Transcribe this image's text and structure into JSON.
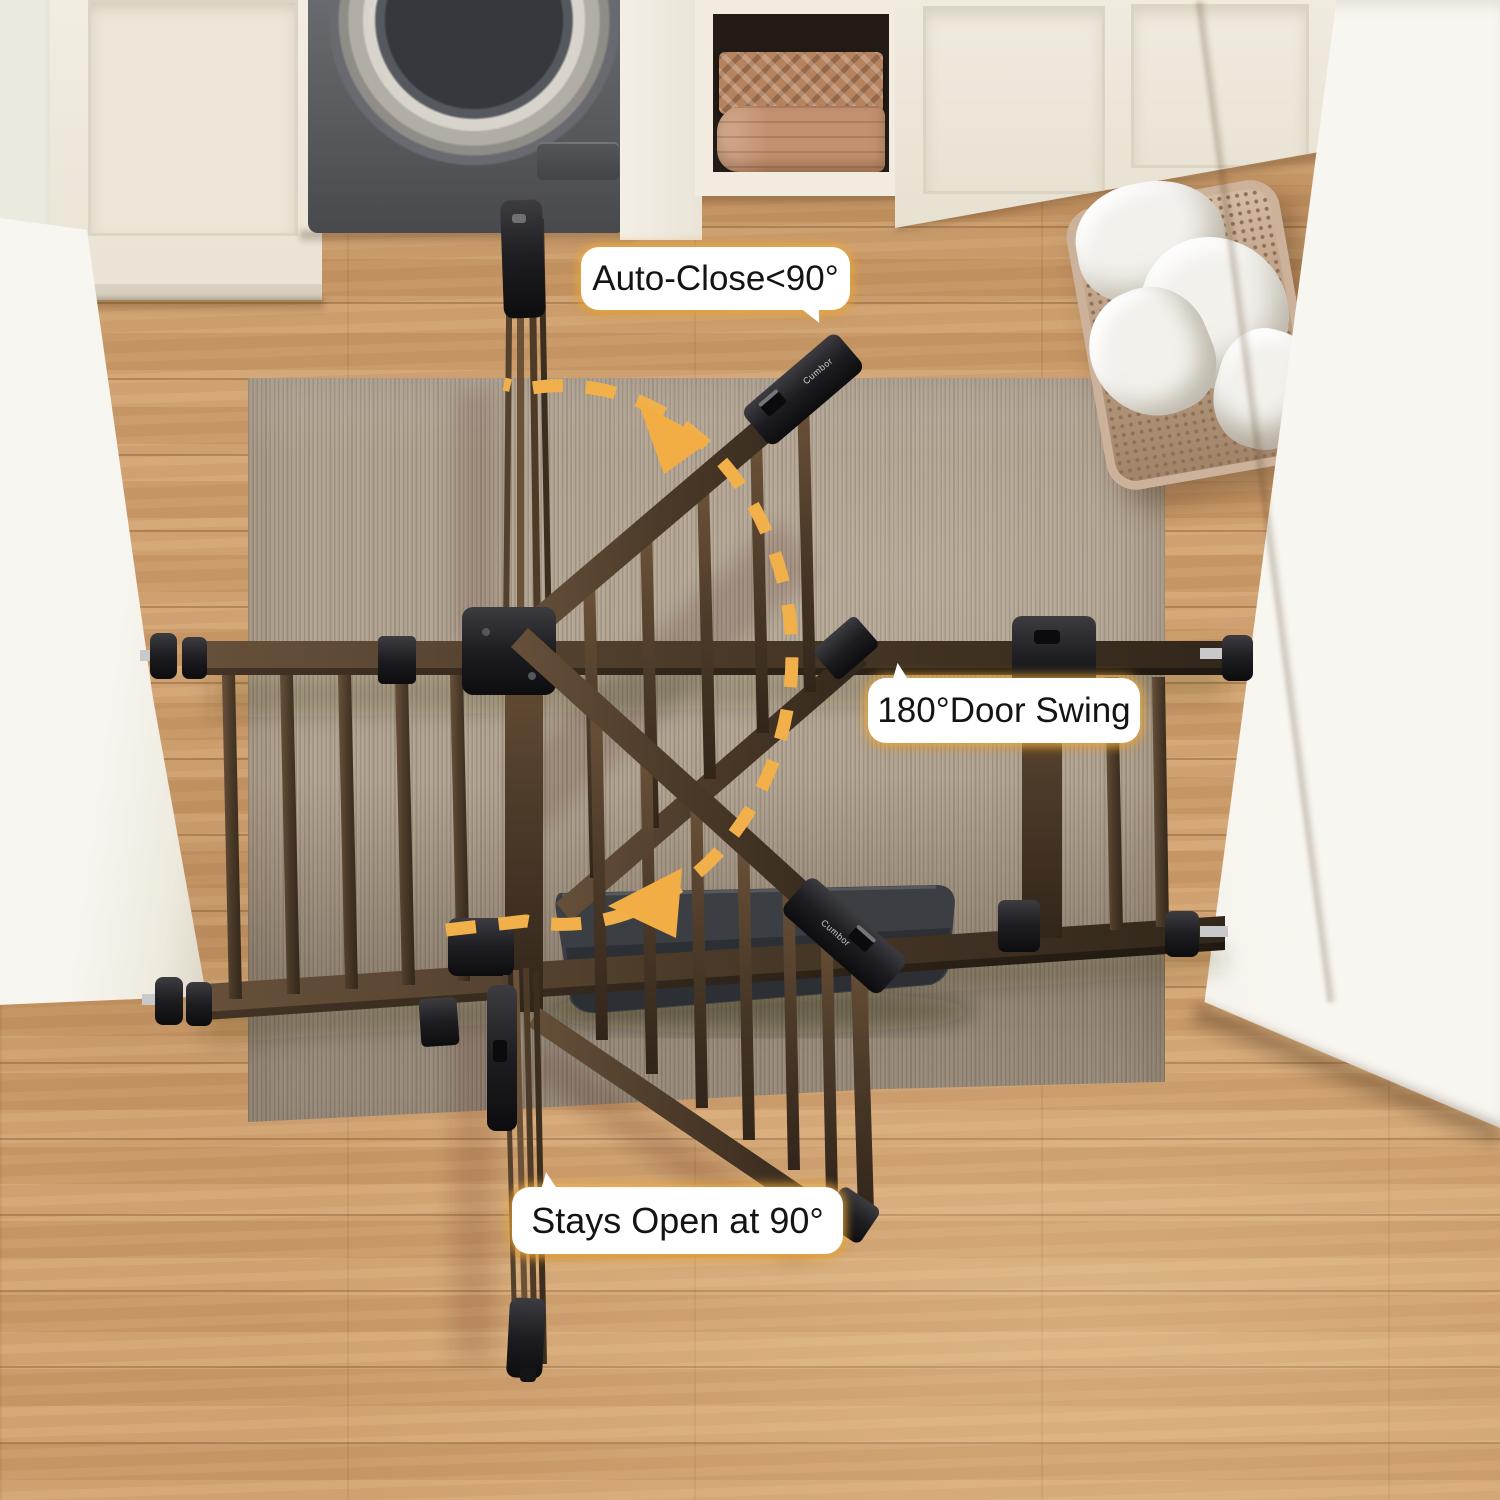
{
  "annotations": {
    "auto_close_label": "Auto-Close<90°",
    "door_swing_label": "180°Door Swing",
    "stays_open_label": "Stays Open at 90°"
  },
  "brand_logo_text": "Cumbor",
  "icons": {
    "swing_path": "dashed-arc",
    "swing_direction_up": "arrowhead-up-left",
    "swing_direction_down": "arrowhead-down-left"
  },
  "colors": {
    "annotation_bubble_bg": "#ffffff",
    "annotation_glow": "#f0ac3c",
    "annotation_text": "#141414",
    "swing_arc": "#f2b04a",
    "gate_metal_brown": "#4d3b29",
    "gate_hardware_black": "#1d1d20",
    "rug": "#b2a492",
    "wood_floor": "#cf9e6c",
    "walls": "#efece4",
    "left_door": "#f7f5ef",
    "floor_mat": "#35383c",
    "washer_body": "#5b5c60",
    "towels": "#b5835f",
    "laundry_basket": "#c2a68c",
    "laundry_cloth": "#f3f1ec"
  }
}
